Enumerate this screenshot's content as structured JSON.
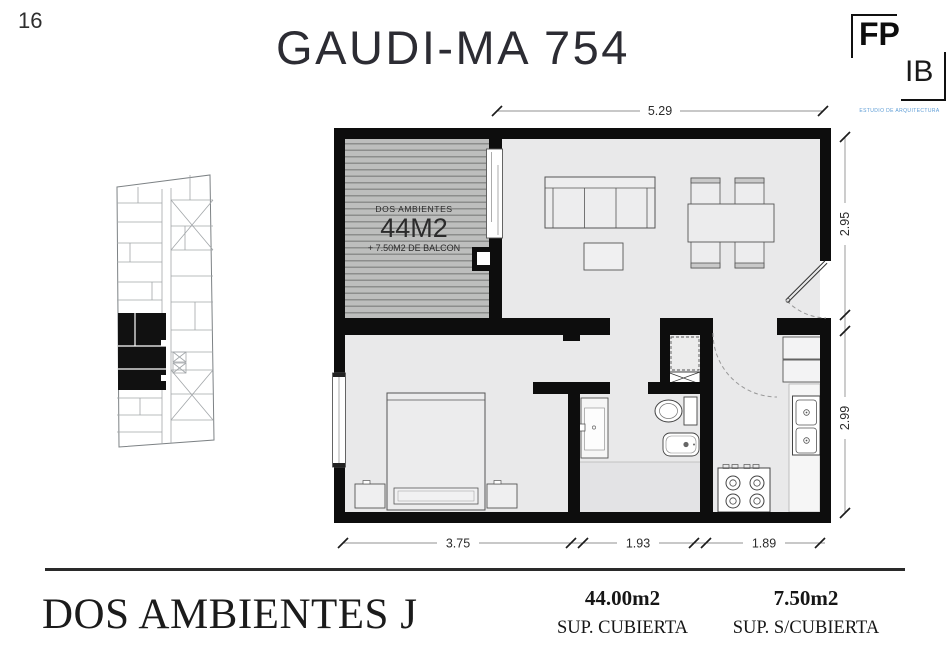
{
  "page": {
    "number": "16"
  },
  "header": {
    "title": "GAUDI-MA 754"
  },
  "logo": {
    "fp": "FP",
    "ib": "IB",
    "tagline": "ESTUDIO DE ARQUITECTURA"
  },
  "floorplan": {
    "balcony_label": {
      "line1": "DOS AMBIENTES",
      "line2": "44M2",
      "line3": "+ 7.50M2 DE BALCON"
    },
    "dimensions": {
      "top": "5.29",
      "right_top": "2.95",
      "right_bottom": "2.99",
      "bottom_left": "3.75",
      "bottom_center": "1.93",
      "bottom_right": "1.89"
    }
  },
  "footer": {
    "unit_name": "DOS AMBIENTES J",
    "areas": [
      {
        "value": "44.00m2",
        "label": "SUP. CUBIERTA"
      },
      {
        "value": "7.50m2",
        "label": "SUP. S/CUBIERTA"
      }
    ]
  },
  "colors": {
    "wall": "#0d0d0d",
    "floor": "#e9e9ea",
    "balcony": "#bcbdbc",
    "tagline_blue": "#5b9bd5"
  }
}
